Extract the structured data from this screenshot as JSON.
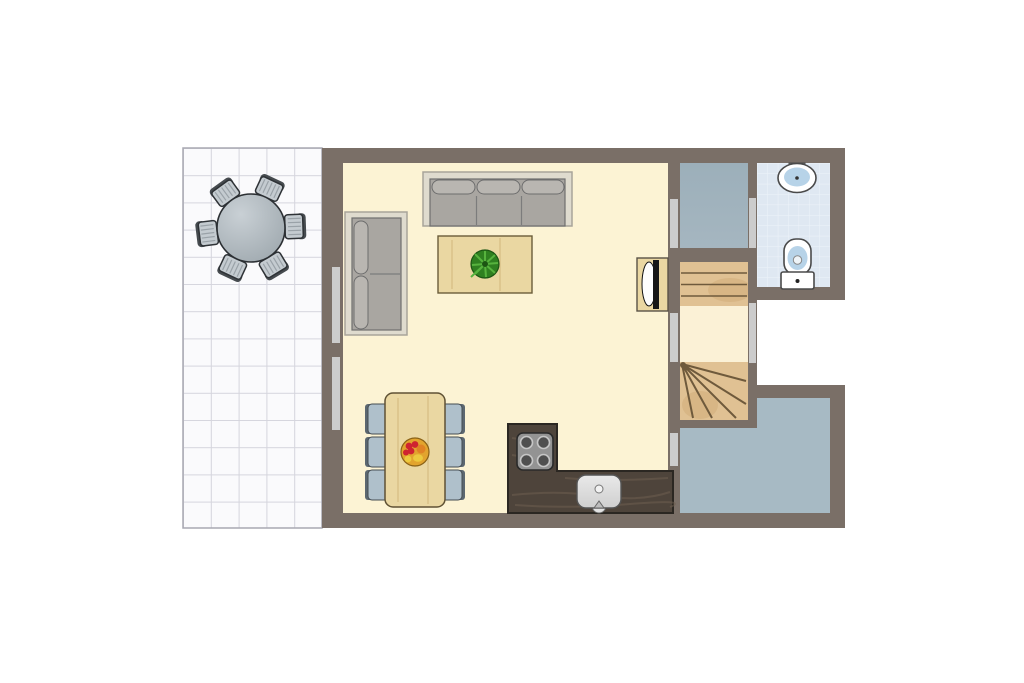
{
  "type": "floor-plan",
  "title": "holiday-home ground floor plan",
  "palette": {
    "wall": "#7a6f67",
    "doorway": "#cccccc",
    "outline": "#2e3236",
    "terrace_tile": "#fafafc",
    "terrace_line": "#d5d5dd",
    "terrace_border": "#a8a8b2",
    "table_top_light": "#c9d0d5",
    "table_top_dark": "#9ba5ab",
    "terrace_chair_seat": "#c4cbd0",
    "terrace_chair_back": "#464b4f",
    "living_floor": "#fcf3d4",
    "landing_floor": "#fbf1d6",
    "storage_floor": "#a5b6c0",
    "hallway_floor": "#a7bac4",
    "bath_tile": "#dfe8f2",
    "bath_line": "#eef3f9",
    "stair_wood": "#e0c193",
    "stair_wood_shade": "#c9a36c",
    "stair_line": "#6f5a3c",
    "wood_light": "#ead7a2",
    "wood_outline": "#6b5c3a",
    "counter": "#4e443b",
    "counter_streak": "#6e5f51",
    "sofa_platform": "#dfdbce",
    "sofa_platform_edge": "#a8a49a",
    "sofa_body": "#a9a6a1",
    "sofa_cushion": "#b9b6b1",
    "sofa_outline": "#6f6f6f",
    "dining_chair_seat": "#afc0cb",
    "dining_chair_back": "#5c6770",
    "plant": "#2f8020",
    "plant_leaf": "#57b33e",
    "plant_dark": "#1c5513",
    "bowl": "#e2a42e",
    "fruit_red": "#cf2330",
    "fruit_orange": "#e08224",
    "fruit_yellow": "#ecc93e",
    "stove_panel": "#939393",
    "burner": "#4f4f4f",
    "burner_ring": "#c6c6c6",
    "sink_metal": "#cfcfcf",
    "fixture_white": "#ffffff",
    "fixture_blue": "#b7d3e8",
    "fixture_outline": "#4a4a4a",
    "tv_black": "#161616"
  },
  "rooms": [
    {
      "id": "terrace",
      "label": "tiled terrace with round table and six chairs"
    },
    {
      "id": "living-room",
      "label": "open living room / kitchen with cream floor"
    },
    {
      "id": "storage",
      "label": "small blue-grey room top right"
    },
    {
      "id": "staircase",
      "label": "wooden staircase with landing and winder steps"
    },
    {
      "id": "bathroom",
      "label": "tiled bathroom with washbasin and toilet"
    },
    {
      "id": "hallway",
      "label": "L-shaped blue-grey hallway bottom right"
    }
  ],
  "furniture": [
    "round-terrace-table",
    "terrace-chair x6",
    "three-seat-sofa",
    "two-seat-sofa",
    "coffee-table",
    "potted-plant",
    "tv-cabinet",
    "dining-table",
    "dining-chair x6",
    "fruit-bowl",
    "kitchen-counter",
    "cooktop-4-burners",
    "kitchen-sink",
    "washbasin",
    "toilet"
  ]
}
